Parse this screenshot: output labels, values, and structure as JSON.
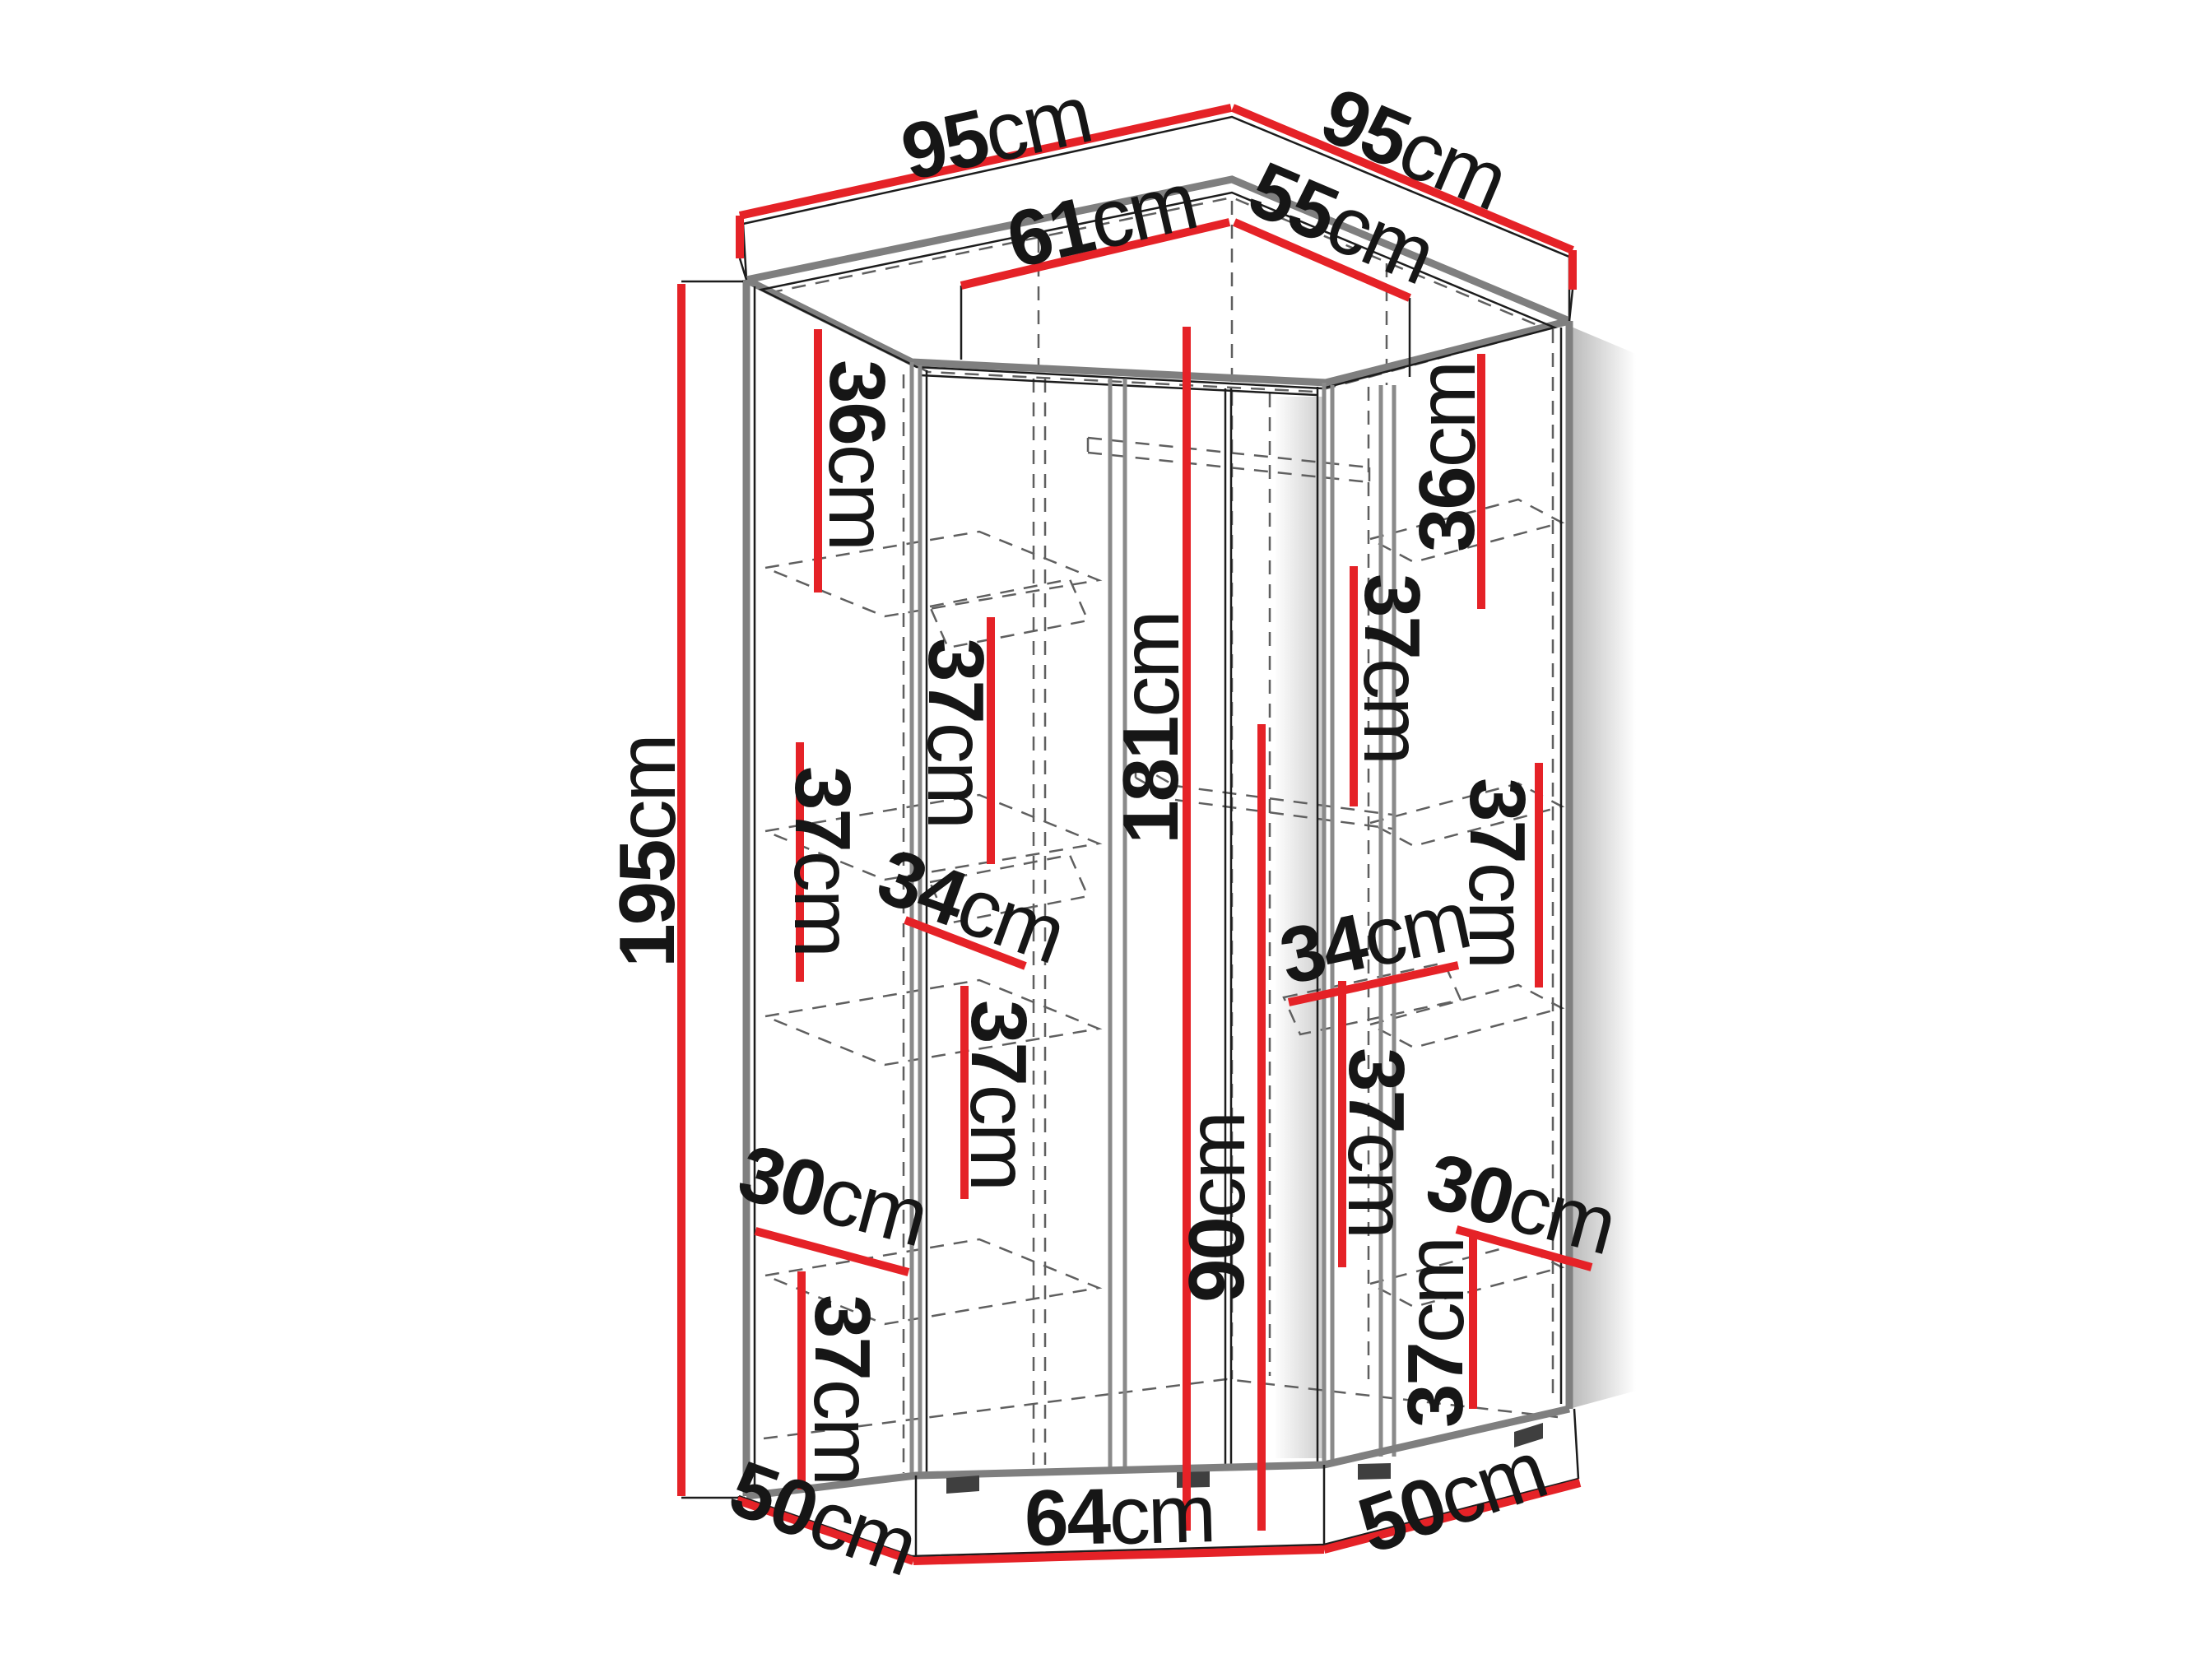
{
  "diagram": {
    "kind": "corner-wardrobe-dimension-diagram",
    "colors": {
      "dimension_line_red": "#e52227",
      "edge_gray": "#7f7f7f",
      "hidden_edge_gray": "#5f5f5f",
      "text_black": "#161616",
      "background": "#ffffff"
    }
  },
  "labels": [
    {
      "name": "width-back-left",
      "value": "95",
      "unit": "cm"
    },
    {
      "name": "width-back-right",
      "value": "95",
      "unit": "cm"
    },
    {
      "name": "inner-width-left",
      "value": "61",
      "unit": "cm"
    },
    {
      "name": "inner-width-right",
      "value": "55",
      "unit": "cm"
    },
    {
      "name": "total-height",
      "value": "195",
      "unit": "cm"
    },
    {
      "name": "left-top-gap",
      "value": "36",
      "unit": "cm"
    },
    {
      "name": "left-corner-gap-upper",
      "value": "37",
      "unit": "cm"
    },
    {
      "name": "left-middle-gap",
      "value": "37",
      "unit": "cm"
    },
    {
      "name": "left-shelf-depth",
      "value": "34",
      "unit": "cm"
    },
    {
      "name": "left-corner-gap-lower",
      "value": "37",
      "unit": "cm"
    },
    {
      "name": "left-lower-shelf-depth",
      "value": "30",
      "unit": "cm"
    },
    {
      "name": "left-bottom-gap",
      "value": "37",
      "unit": "cm"
    },
    {
      "name": "door-inner-height",
      "value": "181",
      "unit": "cm"
    },
    {
      "name": "center-lower-height",
      "value": "90",
      "unit": "cm"
    },
    {
      "name": "right-top-gap",
      "value": "36",
      "unit": "cm"
    },
    {
      "name": "right-corner-gap-upper",
      "value": "37",
      "unit": "cm"
    },
    {
      "name": "right-tall-gap",
      "value": "37",
      "unit": "cm"
    },
    {
      "name": "right-shelf-depth",
      "value": "34",
      "unit": "cm"
    },
    {
      "name": "right-corner-gap-lower",
      "value": "37",
      "unit": "cm"
    },
    {
      "name": "right-lower-shelf-depth",
      "value": "30",
      "unit": "cm"
    },
    {
      "name": "right-bottom-gap",
      "value": "37",
      "unit": "cm"
    },
    {
      "name": "base-depth-left",
      "value": "50",
      "unit": "cm"
    },
    {
      "name": "base-width-front",
      "value": "64",
      "unit": "cm"
    },
    {
      "name": "base-depth-right",
      "value": "50",
      "unit": "cm"
    }
  ]
}
